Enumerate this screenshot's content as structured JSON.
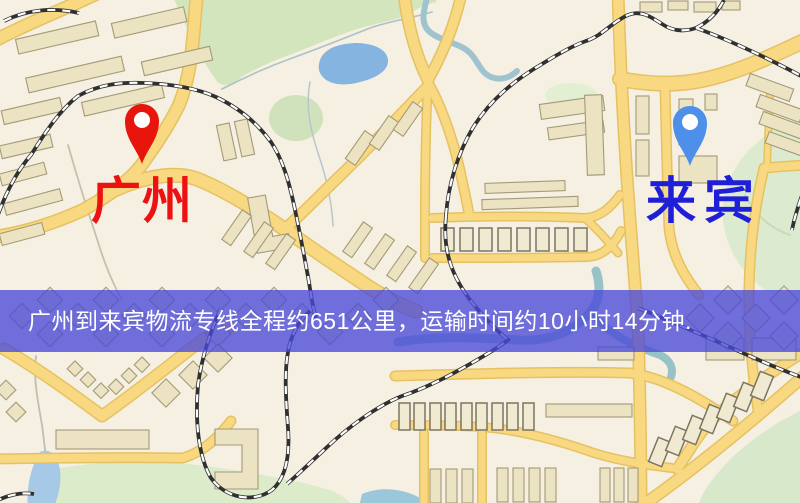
{
  "banner": {
    "text": "广州到来宾物流专线全程约651公里，运输时间约10小时14分钟."
  },
  "markers": {
    "origin": {
      "label": "广州",
      "icon": "map-pin-icon"
    },
    "destination": {
      "label": "来宾",
      "icon": "map-pin-icon"
    }
  },
  "colors": {
    "origin-marker": "#e8150d",
    "origin-label": "#ee1111",
    "destination-marker": "#4e8fe9",
    "destination-label": "#1f1fd8",
    "banner-bg": "rgba(73,73,216,0.78)",
    "banner-text": "#ffffff",
    "road": "#f8d981",
    "water": "#85b4e0",
    "park": "#d3e5bd"
  }
}
